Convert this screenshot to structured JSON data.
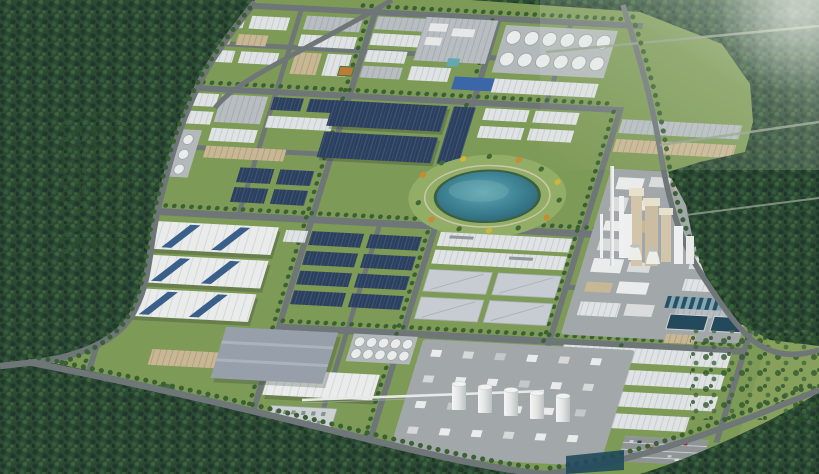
{
  "scene": {
    "type": "aerial-3d-architectural-render",
    "description": "Bird's-eye 3D rendering of a large industrial park surrounded by dense forest: grid of tree-lined roads, rows of white, gray and navy-blue roofed factory halls and warehouses, a central landscaped lake with autumn trees, white storage tank farms, a cement plant with chimneys and cooling towers, a chemical plant with silo rows, water-treatment pools, offices and parking lots; misty light-green hills at the top right.",
    "landmarks": [
      "forest hills",
      "perimeter roads",
      "industrial park road grid",
      "white warehouse halls",
      "navy-roof factory halls",
      "large skylight warehouses",
      "landscaped lake and park",
      "storage tank farm",
      "cement plant with chimneys and cooling towers",
      "chemical plant with silos",
      "water treatment pools",
      "office building",
      "parking lots",
      "crop field strips",
      "retention ponds"
    ],
    "palette": {
      "grass": "#87a15c",
      "lawn": "#7e9a57",
      "lawnLight": "#92ad66",
      "forest": "#2b4a34",
      "forestDark": "#21392a",
      "forestLight": "#4a713f",
      "road": "#6f7678",
      "roadMinor": "#93a08f",
      "roofWhite": "#dfe3e4",
      "roofWhiteLine": "#c8cdd0",
      "roofBright": "#e9eceb",
      "roofGray": "#b7bdc1",
      "roofGrayLine": "#a5abb0",
      "roofNavy": "#2c3f5c",
      "roofNavyLine": "#3d5577",
      "roofTan": "#c8b795",
      "roofTanLine": "#b3a07a",
      "roofFlat": "#c6ccd1",
      "concrete": "#a2a8a9",
      "pad": "#b3b9ba",
      "water": "#3f8495",
      "waterDeep": "#2b6576",
      "waterLight": "#63a8b2",
      "poolDark": "#24485c",
      "sand": "#cbc6a8",
      "treeGreen": "#3a6134",
      "treeOrange": "#cd8832",
      "treeYellow": "#d2b43c",
      "silo": "#e9eceb",
      "chimney": "#eff1f0",
      "tanTower": "#d2c5a9",
      "parking": "#8f9495",
      "grayRoofBig": "#97a0aa",
      "solarBlue": "#3b67a9",
      "courtOrange": "#bf7a35"
    }
  }
}
